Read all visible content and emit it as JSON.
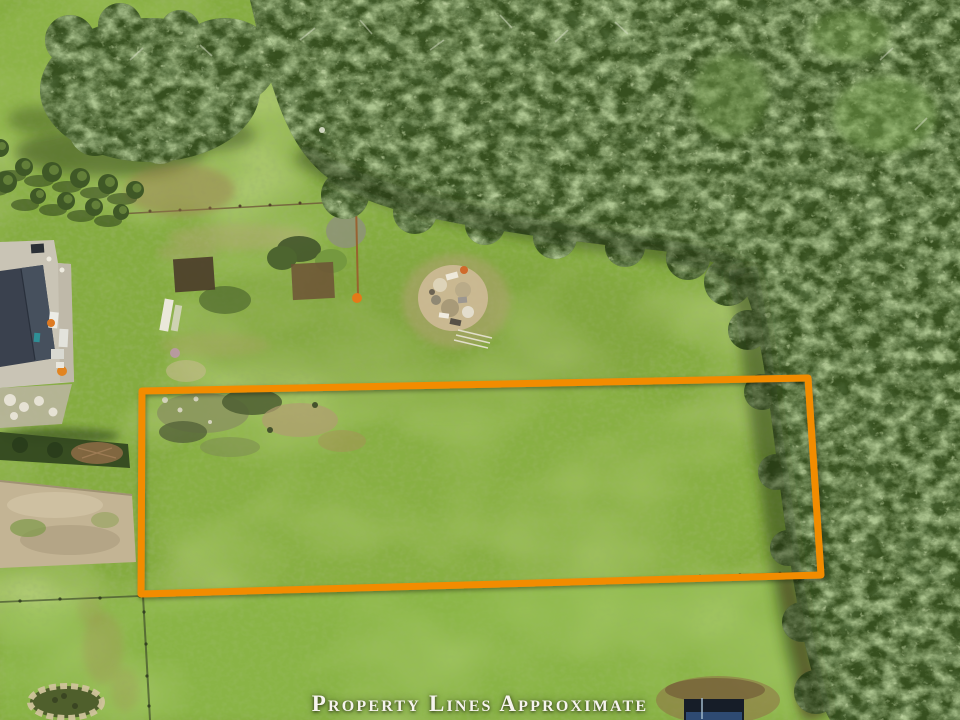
{
  "page": {
    "kind": "aerial-drone-photograph",
    "width": 960,
    "height": 720
  },
  "overlay": {
    "caption": "Property Lines Approximate",
    "caption_color": "#F6F4EE",
    "boundary_color": "#F28C05",
    "boundary_stroke_width": "7",
    "boundary_points": "142,391 808,378 821,575 141,594"
  },
  "scene": {
    "description": "Top-down drone view of a grassy acreage parcel outlined in orange; dense evergreen forest across the top and down the right side; house with dark roof at left edge; garden beds, debris pile, fences, gravel drive, stone fire ring and small shed.",
    "colors": {
      "grass": "#85AC40",
      "grass_bright": "#92C150",
      "forest": "#37501F",
      "forest_shadow": "#1D2C10",
      "dirt_road": "#C3B494",
      "debris": "#CBB994",
      "house_roof": "#3A414E",
      "concrete_pad": "#C9C4B5"
    },
    "features": [
      {
        "name": "forest-canopy",
        "desc": "dense evergreen forest, top and right"
      },
      {
        "name": "conifer-cluster",
        "desc": "cluster of conifers, upper left"
      },
      {
        "name": "shrub-row",
        "desc": "row of small shrubs below the conifers"
      },
      {
        "name": "house",
        "desc": "dark-roofed house on concrete pad, left edge"
      },
      {
        "name": "garden-area",
        "desc": "garden beds, brush piles and markers"
      },
      {
        "name": "debris-pile",
        "desc": "light burn/debris pile in the field"
      },
      {
        "name": "dirt-road",
        "desc": "gravel drive along the left edge"
      },
      {
        "name": "pasture",
        "desc": "open green pasture"
      },
      {
        "name": "fence-line",
        "desc": "wire fence with posts along lower boundary"
      },
      {
        "name": "stone-fire-ring",
        "desc": "ring of stones, bottom left"
      },
      {
        "name": "shed",
        "desc": "small dark outbuilding, bottom right"
      }
    ]
  }
}
